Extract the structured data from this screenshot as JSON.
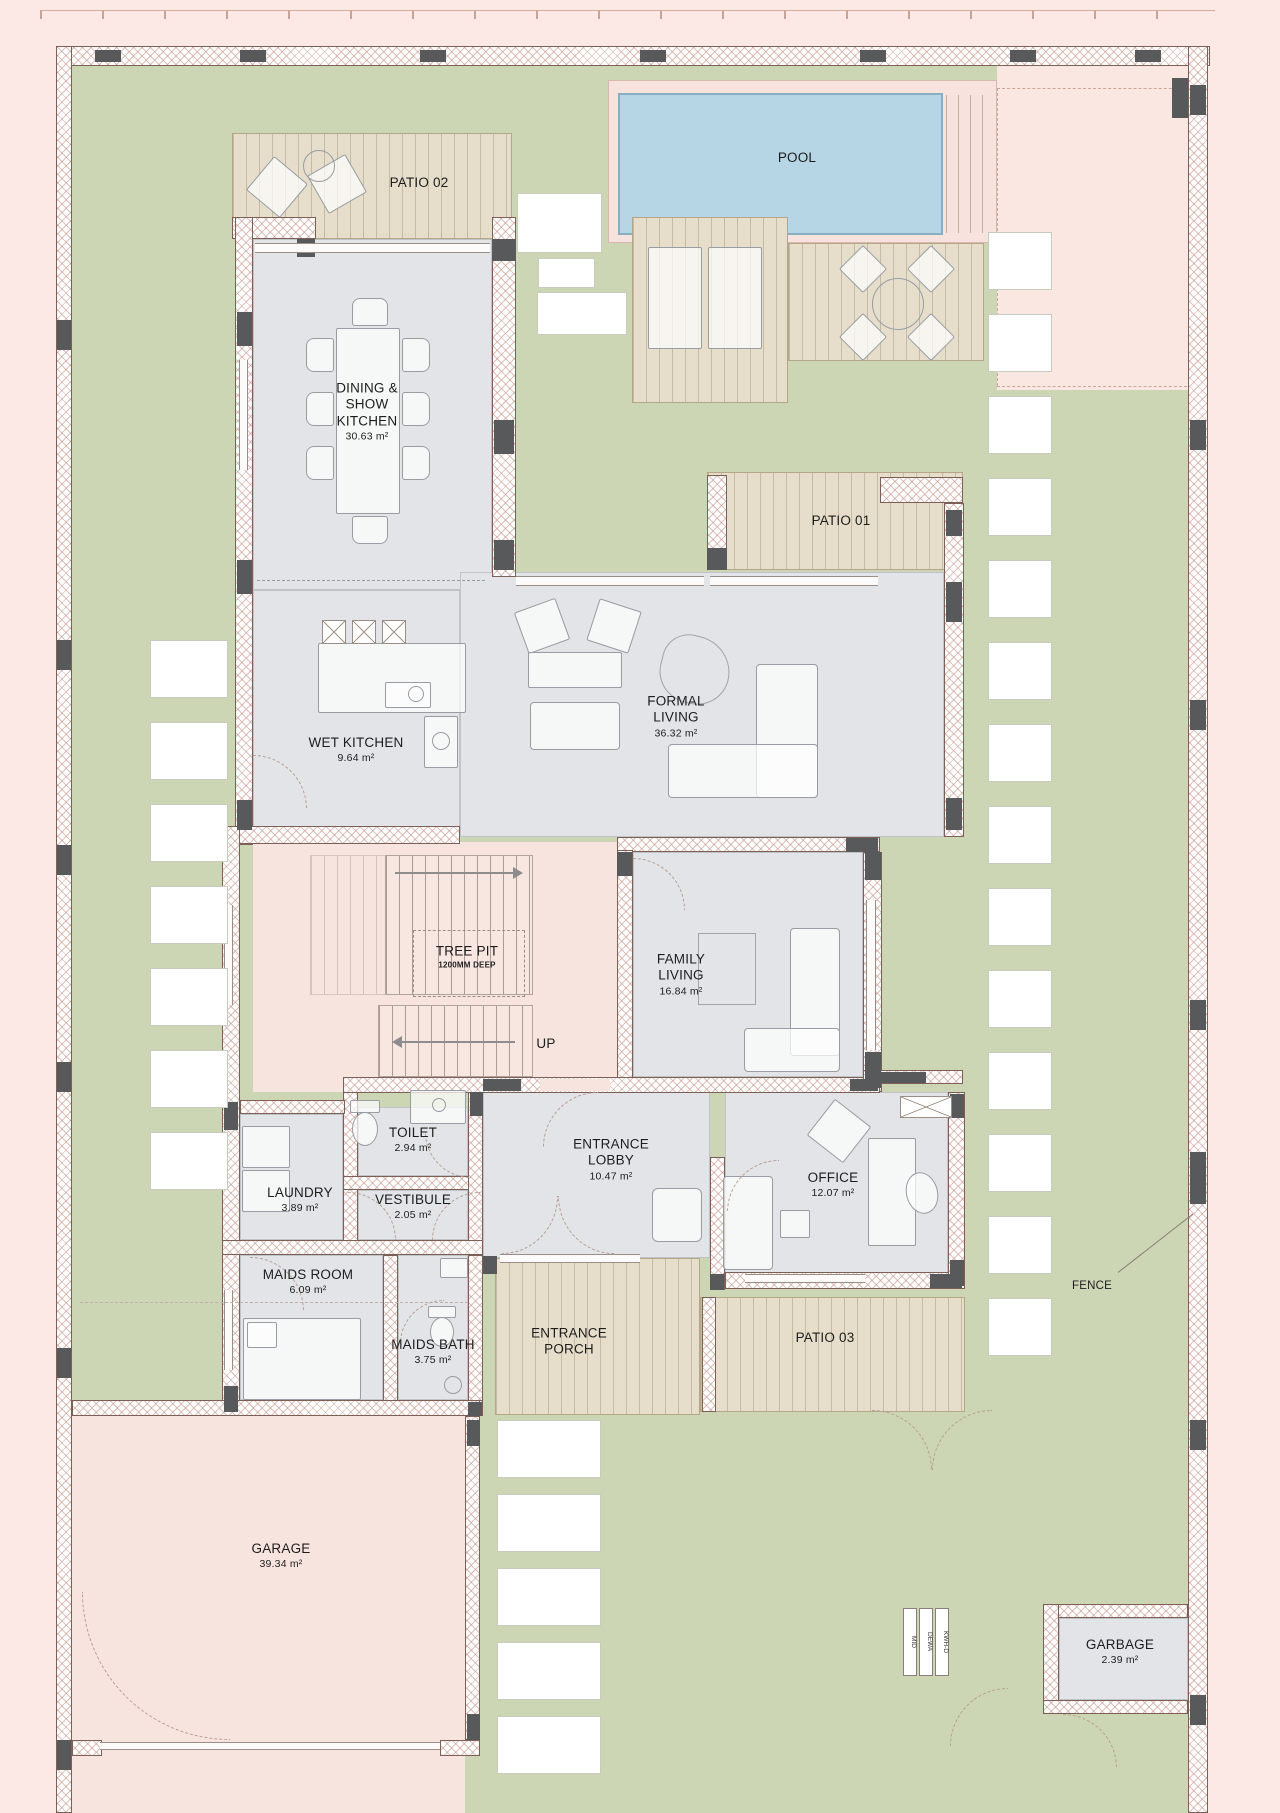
{
  "plan_title": "Villa ground floor plan",
  "rooms": {
    "pool": {
      "name": "POOL"
    },
    "patio01": {
      "name": "PATIO 01"
    },
    "patio02": {
      "name": "PATIO 02"
    },
    "patio03": {
      "name": "PATIO 03"
    },
    "dining": {
      "name": "DINING & SHOW KITCHEN",
      "area": "30.63 m²"
    },
    "formal_living": {
      "name": "FORMAL LIVING",
      "area": "36.32 m²"
    },
    "wet_kitchen": {
      "name": "WET KITCHEN",
      "area": "9.64 m²"
    },
    "family_living": {
      "name": "FAMILY LIVING",
      "area": "16.84 m²"
    },
    "tree_pit": {
      "name": "TREE PIT",
      "note": "1200MM DEEP"
    },
    "stairs": {
      "up": "UP"
    },
    "toilet": {
      "name": "TOILET",
      "area": "2.94 m²"
    },
    "laundry": {
      "name": "LAUNDRY",
      "area": "3.89 m²"
    },
    "vestibule": {
      "name": "VESTIBULE",
      "area": "2.05 m²"
    },
    "entrance_lobby": {
      "name": "ENTRANCE LOBBY",
      "area": "10.47 m²"
    },
    "office": {
      "name": "OFFICE",
      "area": "12.07 m²"
    },
    "maids_room": {
      "name": "MAIDS ROOM",
      "area": "6.09 m²"
    },
    "maids_bath": {
      "name": "MAIDS BATH",
      "area": "3.75 m²"
    },
    "entrance_porch": {
      "name": "ENTRANCE PORCH"
    },
    "garage": {
      "name": "GARAGE",
      "area": "39.34 m²"
    },
    "garbage": {
      "name": "GARBAGE",
      "area": "2.39 m²"
    }
  },
  "annotations": {
    "fence": "FENCE"
  },
  "meters": {
    "m1": "MID",
    "m2": "DEWA",
    "m3": "KWH-D"
  },
  "colors": {
    "outside": "#fce9e5",
    "lawn": "#ccd6b5",
    "deck": "#e6decb",
    "pool_water": "#b6d6e6",
    "floor_gray": "#e2e4e7",
    "floor_pink": "#f8e4de",
    "wall_dark": "#58595b",
    "wall_hatch_line": "#c08d80"
  }
}
